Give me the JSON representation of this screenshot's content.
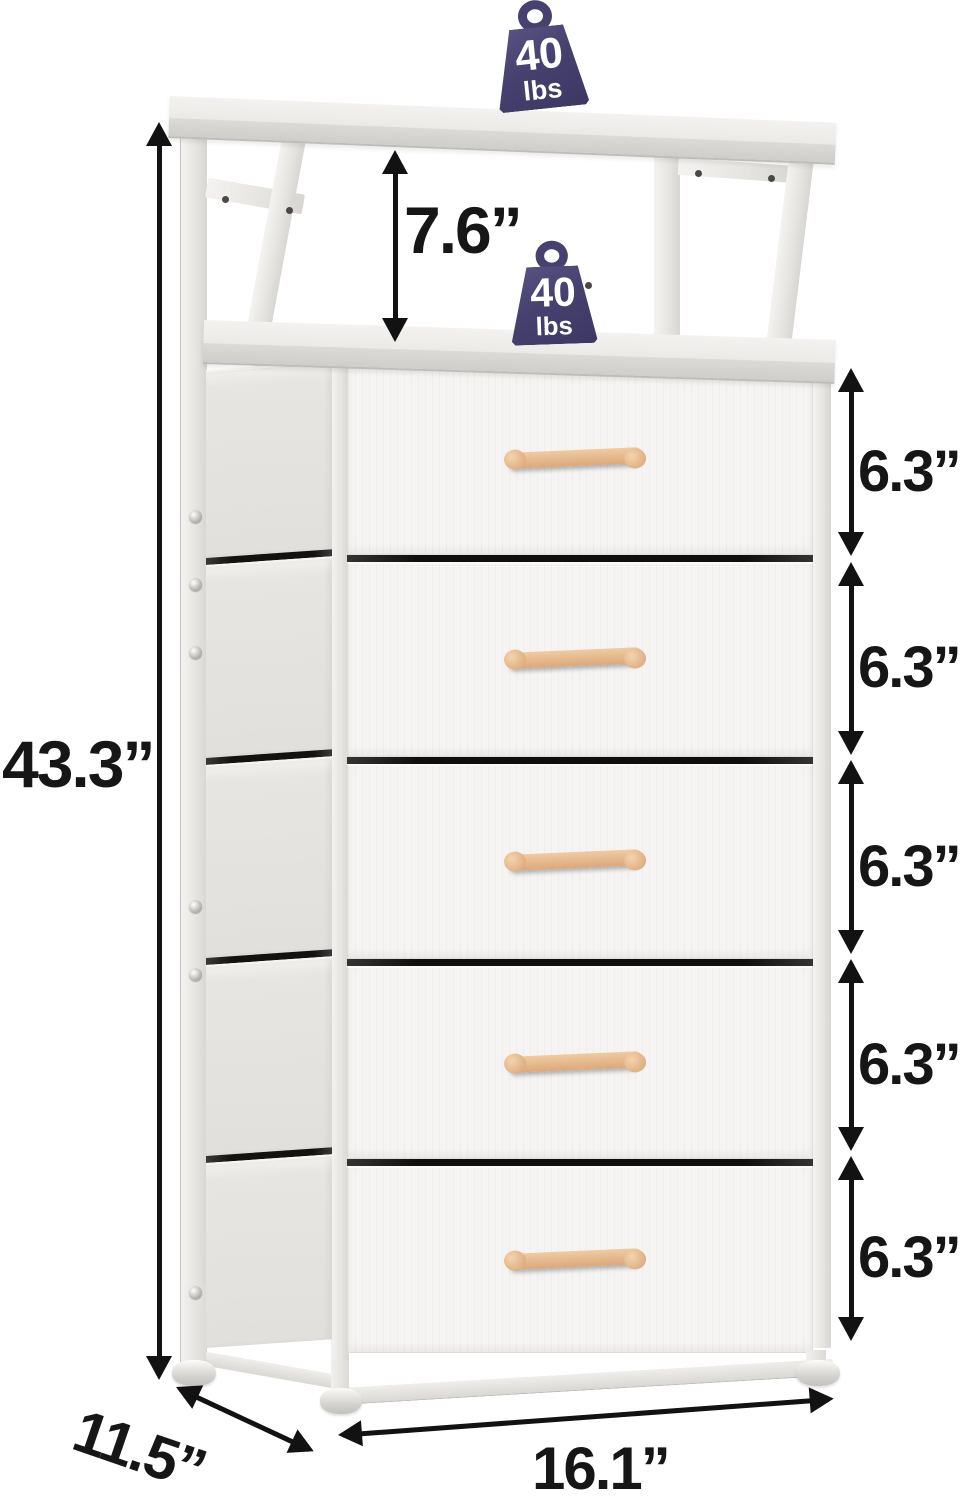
{
  "product": {
    "name": "5-drawer fabric storage tower with open top shelf"
  },
  "labels": {
    "overall_height": "43.3”",
    "shelf_clearance": "7.6”",
    "drawer_heights": [
      "6.3”",
      "6.3”",
      "6.3”",
      "6.3”",
      "6.3”"
    ],
    "width": "16.1”",
    "depth": "11.5”"
  },
  "weights": {
    "top_shelf": {
      "value": "40",
      "unit": "lbs"
    },
    "middle_shelf": {
      "value": "40",
      "unit": "lbs"
    }
  },
  "colors": {
    "dimension_text": "#161616",
    "weight_badge": "#46416f",
    "weight_text": "#ffffff",
    "frame_white": "#eceae7",
    "drawer_front": "#f5f4f2",
    "drawer_side": "#e5e3e0",
    "handle_wood": "#e0b287",
    "gap_dark": "#0e0e0c"
  }
}
